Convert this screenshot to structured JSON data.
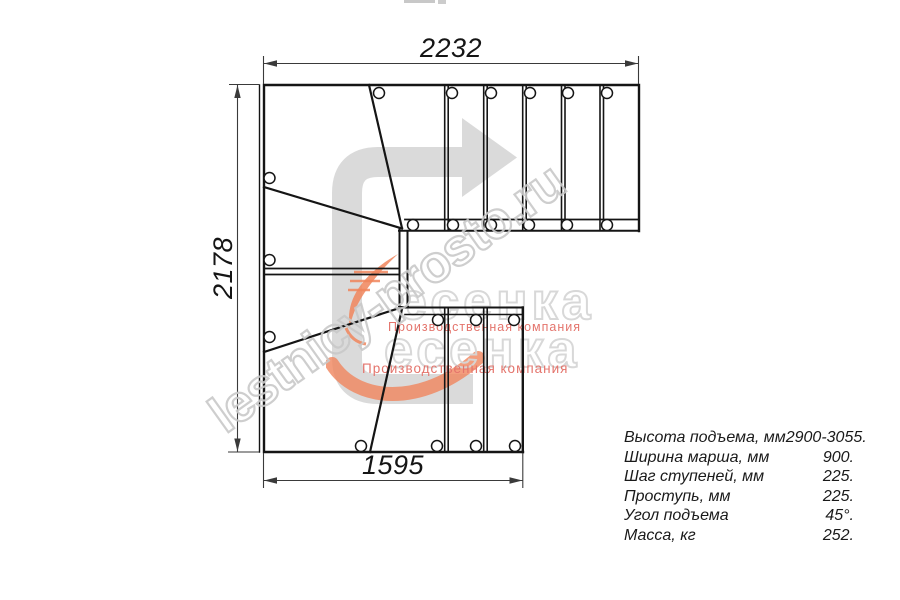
{
  "dimensions": {
    "top": "2232",
    "left": "2178",
    "bottom": "1595"
  },
  "spec_table": {
    "rows": [
      {
        "label": "Высота подъема, мм",
        "value": "2900-3055."
      },
      {
        "label": "Ширина марша, мм",
        "value": "900."
      },
      {
        "label": "Шаг ступеней, мм",
        "value": "225."
      },
      {
        "label": "Проступь, мм",
        "value": "225."
      },
      {
        "label": "Угол подъема",
        "value": "45°."
      },
      {
        "label": "Масса, кг",
        "value": "252."
      }
    ]
  },
  "watermarks": {
    "site": "lestnicy-prosto.ru",
    "logo_text": "есенка",
    "tagline": "Производственная компания"
  },
  "colors": {
    "line": "#151515",
    "dimension": "#3a3a3a",
    "direction_arrow": "#dadada",
    "watermark_gray": "#c9c9c9",
    "logo_orange": "#f0855c",
    "logo_red": "#e4746c"
  }
}
